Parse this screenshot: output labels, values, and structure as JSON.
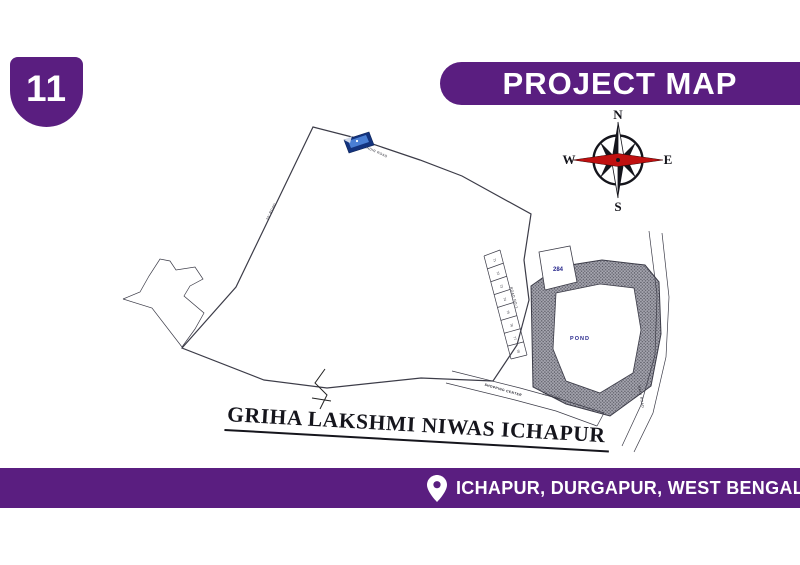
{
  "badge": {
    "number": "11"
  },
  "header": {
    "title": "PROJECT MAP"
  },
  "footer": {
    "location": "ICHAPUR, DURGAPUR, WEST BENGAL 713363"
  },
  "colors": {
    "purple": "#5a1e80",
    "navy": "#28288c",
    "map_line": "#3c3c48",
    "compass_red": "#c01010",
    "flag_blue": "#13337e"
  },
  "map": {
    "title": "GRIHA LAKSHMI NIWAS ICHAPUR",
    "pond_label": "POND",
    "plot_284_label": "284",
    "compass": {
      "north": "N",
      "south": "S",
      "east": "E",
      "west": "W"
    },
    "north_bands": [
      {
        "prefix": "L",
        "single": true,
        "start": 31
      },
      {
        "prefix": "K"
      },
      {
        "prefix": "J"
      },
      {
        "prefix": "H"
      },
      {
        "prefix": "G"
      },
      {
        "prefix": ""
      }
    ],
    "south_bands": [
      {
        "prefix": "E"
      },
      {
        "prefix": "D"
      },
      {
        "prefix": "C"
      },
      {
        "prefix": "B"
      },
      {
        "prefix": "A"
      },
      {
        "prefix": ""
      }
    ],
    "numeric_plots": [
      "71",
      "72",
      "73",
      "74",
      "75",
      "76",
      "77",
      "78"
    ],
    "road_labels": {
      "west_road": "20' ROAD",
      "mandir_road": "MANDIR ROAD",
      "south_roads": [
        "ROAD NO-5",
        "ROAD NO-3",
        "ROAD NO-2",
        "20' ROAD"
      ],
      "east_road": "ROAD NO-1",
      "main_road": "MAIN ROAD",
      "shopping_center": "SHOPPING CENTER",
      "road_25": "25' ROAD"
    }
  }
}
